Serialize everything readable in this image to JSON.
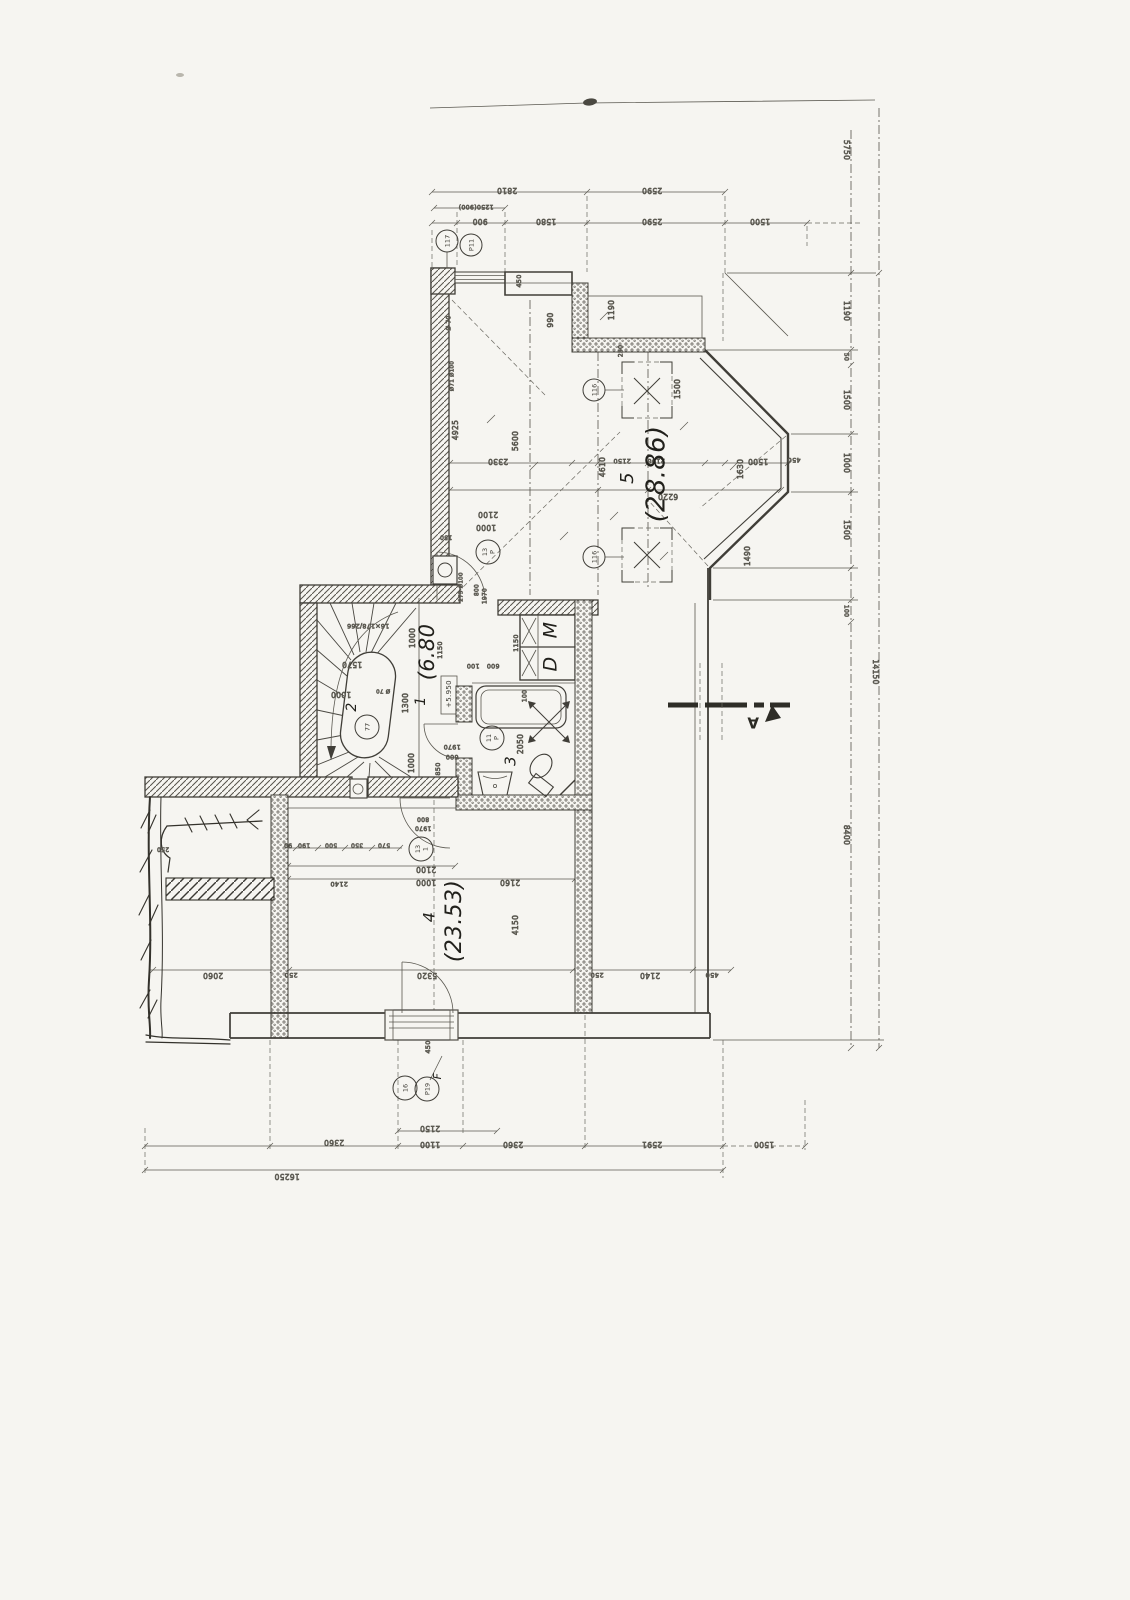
{
  "drawing": {
    "kind": "architectural floor plan (scanned, hand-drafted)"
  },
  "colors": {
    "paper": "#f6f5f1",
    "ink": "#403e38",
    "pencil": "#5a5850",
    "handwriting": "#22211c"
  },
  "rooms": [
    {
      "number": "1",
      "area": "(6.80"
    },
    {
      "number": "2"
    },
    {
      "number": "3"
    },
    {
      "number": "4",
      "area": "(23.53)"
    },
    {
      "number": "5",
      "area": "(28.86)"
    },
    {
      "letter": "M"
    },
    {
      "letter": "D"
    }
  ],
  "level_mark": "+5.950",
  "stair_annotation": "16×178/266",
  "section": {
    "letter": "A"
  },
  "overall_dims": {
    "bottom": "16250",
    "right": "14150"
  },
  "labels": [
    {
      "t": "2810",
      "x": 507,
      "y": 190,
      "r": 180
    },
    {
      "t": "2590",
      "x": 652,
      "y": 190,
      "r": 180
    },
    {
      "t": "1250(900)",
      "x": 476,
      "y": 207,
      "r": 180,
      "s": 6.2
    },
    {
      "t": "900",
      "x": 480,
      "y": 221,
      "r": 180
    },
    {
      "t": "1580",
      "x": 546,
      "y": 221,
      "r": 180
    },
    {
      "t": "2590",
      "x": 652,
      "y": 221,
      "r": 180
    },
    {
      "t": "1500",
      "x": 760,
      "y": 221,
      "r": 180
    },
    {
      "t": "5750",
      "x": 846,
      "y": 150,
      "r": 90
    },
    {
      "t": "1190",
      "x": 846,
      "y": 311,
      "r": 90
    },
    {
      "t": "50",
      "x": 846,
      "y": 357,
      "r": 90,
      "s": 6
    },
    {
      "t": "1500",
      "x": 846,
      "y": 400,
      "r": 90
    },
    {
      "t": "1000",
      "x": 846,
      "y": 463,
      "r": 90
    },
    {
      "t": "1500",
      "x": 846,
      "y": 530,
      "r": 90
    },
    {
      "t": "100",
      "x": 846,
      "y": 611,
      "r": 90,
      "s": 6
    },
    {
      "t": "8400",
      "x": 846,
      "y": 835,
      "r": 90
    },
    {
      "t": "14150",
      "x": 875,
      "y": 672,
      "r": 90
    },
    {
      "t": "2150",
      "x": 430,
      "y": 1128,
      "r": 180
    },
    {
      "t": "2360",
      "x": 334,
      "y": 1142,
      "r": 180
    },
    {
      "t": "1100",
      "x": 430,
      "y": 1144,
      "r": 180
    },
    {
      "t": "2360",
      "x": 513,
      "y": 1144,
      "r": 180
    },
    {
      "t": "2591",
      "x": 652,
      "y": 1144,
      "r": 180
    },
    {
      "t": "1500",
      "x": 764,
      "y": 1144,
      "r": 180
    },
    {
      "t": "16250",
      "x": 287,
      "y": 1176,
      "r": 180
    },
    {
      "t": "450",
      "x": 519,
      "y": 281,
      "r": -90,
      "s": 6.5
    },
    {
      "t": "990",
      "x": 551,
      "y": 320,
      "r": -90
    },
    {
      "t": "1190",
      "x": 612,
      "y": 310,
      "r": -90
    },
    {
      "t": "250",
      "x": 621,
      "y": 351,
      "r": -90,
      "s": 6
    },
    {
      "t": "Ø 70",
      "x": 449,
      "y": 323,
      "r": -90,
      "s": 5.8
    },
    {
      "t": "Ø71 Ø100",
      "x": 452,
      "y": 376,
      "r": -90,
      "s": 5.5
    },
    {
      "t": "4925",
      "x": 456,
      "y": 430,
      "r": -90
    },
    {
      "t": "5600",
      "x": 516,
      "y": 441,
      "r": -90
    },
    {
      "t": "2330",
      "x": 498,
      "y": 461,
      "r": 180
    },
    {
      "t": "2150",
      "x": 622,
      "y": 461,
      "r": 180,
      "s": 6.5
    },
    {
      "t": "2190",
      "x": 656,
      "y": 461,
      "r": 180,
      "s": 6.5
    },
    {
      "t": "4610",
      "x": 603,
      "y": 467,
      "r": -90
    },
    {
      "t": "6220",
      "x": 668,
      "y": 496,
      "r": 180
    },
    {
      "t": "1630",
      "x": 741,
      "y": 469,
      "r": -90
    },
    {
      "t": "1500",
      "x": 758,
      "y": 461,
      "r": 180
    },
    {
      "t": "450",
      "x": 794,
      "y": 460,
      "r": 180,
      "s": 6.5
    },
    {
      "t": "1500",
      "x": 678,
      "y": 389,
      "r": -90
    },
    {
      "t": "1490",
      "x": 748,
      "y": 556,
      "r": -90
    },
    {
      "t": "2100",
      "x": 488,
      "y": 514,
      "r": 180
    },
    {
      "t": "1000",
      "x": 486,
      "y": 527,
      "r": 180
    },
    {
      "t": "150",
      "x": 446,
      "y": 537,
      "r": 180,
      "s": 6
    },
    {
      "t": "275 Ø100",
      "x": 461,
      "y": 587,
      "r": -90,
      "s": 5.5
    },
    {
      "t": "800",
      "x": 477,
      "y": 590,
      "r": -90,
      "s": 5.8
    },
    {
      "t": "1970",
      "x": 485,
      "y": 596,
      "r": -90,
      "s": 5.8
    },
    {
      "t": "5",
      "x": 628,
      "y": 478,
      "r": -90,
      "k": "hand",
      "s": 18
    },
    {
      "t": "(28.86)",
      "x": 657,
      "y": 474,
      "r": -90,
      "k": "hand",
      "s": 26
    },
    {
      "t": "16×178/266",
      "x": 368,
      "y": 626,
      "r": 180,
      "s": 6.3
    },
    {
      "t": "1570",
      "x": 352,
      "y": 664,
      "r": 180
    },
    {
      "t": "1000",
      "x": 413,
      "y": 638,
      "r": -90
    },
    {
      "t": "1150",
      "x": 440,
      "y": 650,
      "r": -90,
      "s": 6.5
    },
    {
      "t": "(6.80",
      "x": 428,
      "y": 652,
      "r": -90,
      "k": "hand",
      "s": 21
    },
    {
      "t": "1",
      "x": 421,
      "y": 701,
      "r": -90,
      "k": "hand",
      "s": 14
    },
    {
      "t": "+5.950",
      "x": 449,
      "y": 694,
      "r": -90,
      "s": 7,
      "k": "boxed"
    },
    {
      "t": "1300",
      "x": 406,
      "y": 703,
      "r": -90
    },
    {
      "t": "2",
      "x": 352,
      "y": 707,
      "r": -90,
      "k": "hand",
      "s": 14
    },
    {
      "t": "1000",
      "x": 341,
      "y": 694,
      "r": 180
    },
    {
      "t": "Ø 70",
      "x": 383,
      "y": 691,
      "r": 180,
      "s": 5.5
    },
    {
      "t": "1000",
      "x": 412,
      "y": 763,
      "r": -90
    },
    {
      "t": "850",
      "x": 438,
      "y": 769,
      "r": -90,
      "s": 6.5
    },
    {
      "t": "100",
      "x": 473,
      "y": 666,
      "r": 180,
      "s": 6.3
    },
    {
      "t": "600",
      "x": 493,
      "y": 666,
      "r": 180,
      "s": 6.3
    },
    {
      "t": "1150",
      "x": 516,
      "y": 643,
      "r": -90,
      "s": 6.5
    },
    {
      "t": "M",
      "x": 551,
      "y": 630,
      "r": -90,
      "k": "hand",
      "s": 19
    },
    {
      "t": "D",
      "x": 551,
      "y": 664,
      "r": -90,
      "k": "hand",
      "s": 19
    },
    {
      "t": "1970",
      "x": 452,
      "y": 747,
      "r": 180,
      "s": 6.3
    },
    {
      "t": "600",
      "x": 452,
      "y": 757,
      "r": 180,
      "s": 6.3
    },
    {
      "t": "3",
      "x": 511,
      "y": 761,
      "r": -90,
      "k": "hand",
      "s": 15
    },
    {
      "t": "2050",
      "x": 521,
      "y": 744,
      "r": -90
    },
    {
      "t": "100",
      "x": 525,
      "y": 696,
      "r": -90,
      "s": 6
    },
    {
      "t": "A",
      "x": 753,
      "y": 722,
      "r": 180,
      "s": 15,
      "k": "section"
    },
    {
      "t": "800",
      "x": 423,
      "y": 819,
      "r": 180,
      "s": 6
    },
    {
      "t": "1970",
      "x": 423,
      "y": 828,
      "r": 180,
      "s": 6
    },
    {
      "t": "90",
      "x": 288,
      "y": 845,
      "r": 180,
      "s": 6
    },
    {
      "t": "190",
      "x": 304,
      "y": 845,
      "r": 180,
      "s": 6
    },
    {
      "t": "500",
      "x": 331,
      "y": 845,
      "r": 180,
      "s": 6
    },
    {
      "t": "350",
      "x": 357,
      "y": 845,
      "r": 180,
      "s": 6
    },
    {
      "t": "570",
      "x": 384,
      "y": 845,
      "r": 180,
      "s": 6
    },
    {
      "t": "2100",
      "x": 426,
      "y": 869,
      "r": 180
    },
    {
      "t": "1000",
      "x": 426,
      "y": 882,
      "r": 180
    },
    {
      "t": "2140",
      "x": 339,
      "y": 884,
      "r": 180,
      "s": 6.5
    },
    {
      "t": "2160",
      "x": 510,
      "y": 882,
      "r": 180
    },
    {
      "t": "4150",
      "x": 516,
      "y": 925,
      "r": -90
    },
    {
      "t": "4",
      "x": 430,
      "y": 917,
      "r": -90,
      "k": "hand",
      "s": 16
    },
    {
      "t": "(23.53)",
      "x": 455,
      "y": 921,
      "r": -90,
      "k": "hand",
      "s": 22
    },
    {
      "t": "2060",
      "x": 213,
      "y": 975,
      "r": 180
    },
    {
      "t": "250",
      "x": 291,
      "y": 975,
      "r": 180,
      "s": 6.5
    },
    {
      "t": "5320",
      "x": 427,
      "y": 975,
      "r": 180
    },
    {
      "t": "250",
      "x": 597,
      "y": 975,
      "r": 180,
      "s": 6.5
    },
    {
      "t": "2140",
      "x": 650,
      "y": 975,
      "r": 180
    },
    {
      "t": "450",
      "x": 712,
      "y": 975,
      "r": 180,
      "s": 6.5
    },
    {
      "t": "450",
      "x": 428,
      "y": 1047,
      "r": -90,
      "s": 6.5
    },
    {
      "t": "250",
      "x": 163,
      "y": 849,
      "r": 180,
      "s": 6
    },
    {
      "t": "F",
      "x": 438,
      "y": 1076,
      "r": -90,
      "k": "hand",
      "s": 11
    }
  ],
  "circles": [
    {
      "x": 447,
      "y": 241,
      "r": 11,
      "a": "117"
    },
    {
      "x": 471,
      "y": 245,
      "r": 11,
      "a": "P11"
    },
    {
      "x": 594,
      "y": 390,
      "r": 11,
      "a": "116"
    },
    {
      "x": 594,
      "y": 557,
      "r": 11,
      "a": "116"
    },
    {
      "x": 488,
      "y": 552,
      "r": 12,
      "a": "13",
      "b": "P"
    },
    {
      "x": 367,
      "y": 727,
      "r": 12,
      "a": "77"
    },
    {
      "x": 492,
      "y": 738,
      "r": 12,
      "a": "11",
      "b": "P"
    },
    {
      "x": 421,
      "y": 849,
      "r": 12,
      "a": "13",
      "b": "1"
    },
    {
      "x": 405,
      "y": 1088,
      "r": 12,
      "a": "16"
    },
    {
      "x": 427,
      "y": 1089,
      "r": 12,
      "a": "P19"
    }
  ]
}
